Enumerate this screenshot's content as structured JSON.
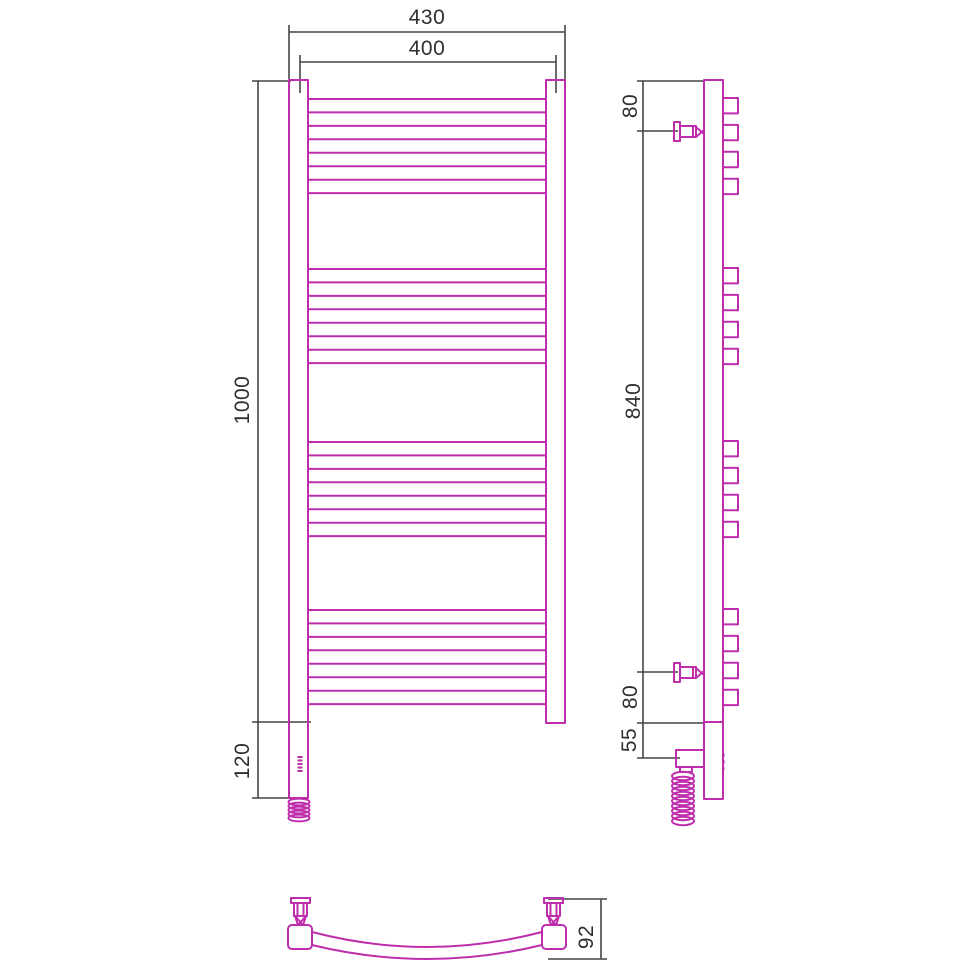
{
  "drawing": {
    "title": "towel-rail technical drawing, three views",
    "front_view": {
      "overall_width": "430",
      "axis_width": "400",
      "height": "1000",
      "lower_section": "120"
    },
    "side_view": {
      "top_bracket_offset": "80",
      "bracket_span": "840",
      "bottom_bracket_offset": "80",
      "outlet_offset": "55"
    },
    "bottom_view": {
      "depth": "92"
    },
    "colors": {
      "product_outline": "#be2eac",
      "dimension_line": "#454545",
      "background": "#ffffff"
    }
  }
}
